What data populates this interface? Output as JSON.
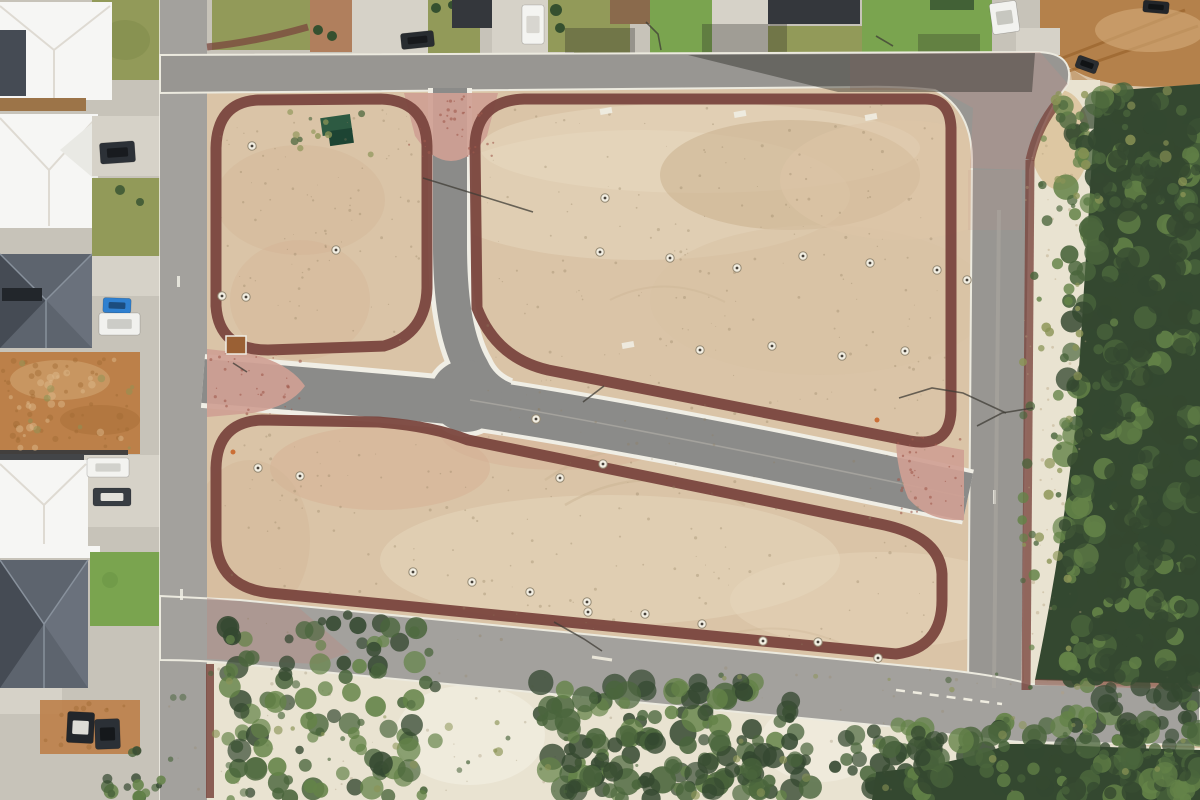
{
  "meta": {
    "description": "Aerial drone photograph of a cleared residential land subdivision: three bare sand lot blocks bounded by new asphalt roads and dark-red concrete footpaths, pink brick intersection aprons, existing houses along the western and northern streets, a dirt track at the north-east corner, and coastal bushland with white sand dunes to the east and south.",
    "image_width": 1200,
    "image_height": 800
  },
  "features": {
    "development": "Cleared subdivision sand lots",
    "roads": "New asphalt subdivision roads",
    "footpaths": "Dark red concrete footpaths with rounded corners",
    "aprons": "Pink brick-paved intersection aprons",
    "left_neighborhood": "Existing houses along western street",
    "top_neighborhood": "Existing houses along northern street",
    "bushland": "Coastal bushland and white sand dunes",
    "dirt_track": "Unsealed sand track at north-east corner",
    "dumpster": "Green waste skip bins on lot",
    "utility_markers": "Sewer/service lids on lots"
  },
  "palette": {
    "sand": "#dac4a7",
    "sand_light": "#e6d7bd",
    "sand_pink": "#d5b093",
    "sand_mottle": "#c8ad8a",
    "road": "#989692",
    "road_light": "#a3a19d",
    "road_internal": "#8b8b89",
    "curb": "#f0eee5",
    "maroon": "#7a463e",
    "maroon_dark": "#6b3d36",
    "pink": "#cf9f94",
    "pink_tint": "#c09287",
    "lawn": "#929a59",
    "lawn_bright": "#7aa44f",
    "hedge": "#35502f",
    "olive": "#8b9456",
    "bush_dark": "#344830",
    "bush_mid": "#4a653c",
    "bush_light": "#648348",
    "dune": "#e9e3d1",
    "dune_bright": "#f0ebdd",
    "dirt": "#b4814b",
    "dirt_dark": "#9c672f",
    "dirt_light": "#d3ab79",
    "dirt_lot": "#bc8049",
    "roof_white": "#f6f6f4",
    "roof_white_shade": "#e9e9e4",
    "roof_gray": "#5d646e",
    "roof_gray_dark": "#454b54",
    "roof_gray_light": "#6a717c",
    "roof_dark": "#34373c",
    "roof_brown": "#8a6a4c",
    "tan_strip": "#9c7448",
    "concrete": "#c7c3b9",
    "concrete_light": "#d6d2c8",
    "shadow": "rgba(38,38,34,0.42)"
  },
  "seed": 1337,
  "vehicles": [
    {
      "name": "car-dark-driveway-nw",
      "x": 100,
      "y": 142,
      "w": 35,
      "h": 21,
      "rot": -4,
      "body": "#2c3137",
      "window": "#171a1e"
    },
    {
      "name": "car-blue",
      "x": 103,
      "y": 298,
      "w": 28,
      "h": 15,
      "rot": 2,
      "body": "#2f80d0",
      "window": "#1b4a7a"
    },
    {
      "name": "caravan-white",
      "x": 99,
      "y": 313,
      "w": 41,
      "h": 22,
      "rot": 0,
      "body": "#f1f1ee",
      "window": "#c9c9c4"
    },
    {
      "name": "van-white-west",
      "x": 87,
      "y": 458,
      "w": 42,
      "h": 19,
      "rot": 0,
      "body": "#f3f3f0",
      "window": "#cfcfc9"
    },
    {
      "name": "car-dark-west",
      "x": 93,
      "y": 488,
      "w": 38,
      "h": 18,
      "rot": 0,
      "body": "#383d43",
      "window": "#eceae4"
    },
    {
      "name": "ute-dark-lot-a",
      "x": 67,
      "y": 712,
      "w": 27,
      "h": 31,
      "rot": 3,
      "body": "#22262b",
      "window": "#e8e6df"
    },
    {
      "name": "ute-dark-lot-b",
      "x": 95,
      "y": 719,
      "w": 25,
      "h": 30,
      "rot": -2,
      "body": "#2b3036",
      "window": "#14171a"
    },
    {
      "name": "car-dark-top-lawn",
      "x": 401,
      "y": 32,
      "w": 33,
      "h": 16,
      "rot": -6,
      "body": "#282c30",
      "window": "#16181b"
    },
    {
      "name": "van-white-top",
      "x": 522,
      "y": 5,
      "w": 22,
      "h": 39,
      "rot": 0,
      "body": "#f4f4f1",
      "window": "#d6d4cd"
    },
    {
      "name": "car-white-top-right",
      "x": 991,
      "y": 2,
      "w": 27,
      "h": 31,
      "rot": -8,
      "body": "#f2f2ef",
      "window": "#c4c4bd"
    },
    {
      "name": "trailer-dark-dirt-track",
      "x": 1076,
      "y": 58,
      "w": 22,
      "h": 13,
      "rot": 20,
      "body": "#2a2d31",
      "window": "#101214"
    },
    {
      "name": "car-dark-top-edge",
      "x": 1143,
      "y": 1,
      "w": 26,
      "h": 12,
      "rot": 5,
      "body": "#23262a",
      "window": "#111315"
    }
  ],
  "utility_markers": [
    [
      222,
      296
    ],
    [
      246,
      297
    ],
    [
      336,
      250
    ],
    [
      252,
      146
    ],
    [
      600,
      252
    ],
    [
      670,
      258
    ],
    [
      737,
      268
    ],
    [
      803,
      256
    ],
    [
      870,
      263
    ],
    [
      937,
      270
    ],
    [
      967,
      280
    ],
    [
      605,
      198
    ],
    [
      536,
      419
    ],
    [
      603,
      464
    ],
    [
      700,
      350
    ],
    [
      772,
      346
    ],
    [
      842,
      356
    ],
    [
      905,
      351
    ],
    [
      258,
      468
    ],
    [
      300,
      476
    ],
    [
      560,
      478
    ],
    [
      413,
      572
    ],
    [
      472,
      582
    ],
    [
      530,
      592
    ],
    [
      587,
      602
    ],
    [
      588,
      612
    ],
    [
      645,
      614
    ],
    [
      702,
      624
    ],
    [
      763,
      641
    ],
    [
      818,
      642
    ],
    [
      878,
      658
    ]
  ],
  "survey_pegs": [
    [
      606,
      111
    ],
    [
      740,
      114
    ],
    [
      871,
      117
    ],
    [
      628,
      345
    ]
  ],
  "light_poles": [
    [
      [
        646,
        22
      ],
      [
        658,
        34
      ],
      [
        661,
        50
      ]
    ],
    [
      [
        876,
        36
      ],
      [
        893,
        46
      ]
    ],
    [
      [
        583,
        402
      ],
      [
        604,
        386
      ]
    ],
    [
      [
        899,
        398
      ],
      [
        932,
        388
      ],
      [
        963,
        393
      ],
      [
        1006,
        413
      ]
    ],
    [
      [
        977,
        426
      ],
      [
        1002,
        413
      ],
      [
        1033,
        408
      ]
    ],
    [
      [
        554,
        622
      ],
      [
        584,
        639
      ],
      [
        602,
        651
      ]
    ],
    [
      [
        233,
        363
      ],
      [
        247,
        372
      ]
    ],
    [
      [
        423,
        178
      ],
      [
        533,
        212
      ]
    ]
  ],
  "vegetation_regions": [
    {
      "name": "right-bushland",
      "bounds": [
        1062,
        88,
        138,
        712
      ],
      "count": 300,
      "rmin": 4,
      "rmax": 13,
      "colors": [
        "bush_dark",
        "bush_mid",
        "bush_light"
      ],
      "opacity": 0.92
    },
    {
      "name": "right-bushland-shade",
      "bounds": [
        1100,
        100,
        100,
        700
      ],
      "count": 120,
      "rmin": 5,
      "rmax": 15,
      "colors": [
        "bush_dark"
      ],
      "opacity": 0.85
    },
    {
      "name": "dune-shrubs",
      "bounds": [
        1022,
        110,
        58,
        580
      ],
      "count": 55,
      "rmin": 2,
      "rmax": 6,
      "colors": [
        "bush_mid",
        "olive",
        "bush_light"
      ],
      "opacity": 0.85
    },
    {
      "name": "topright-dune-shrubs",
      "bounds": [
        1040,
        85,
        150,
        140
      ],
      "count": 30,
      "rmin": 2,
      "rmax": 6,
      "colors": [
        "bush_mid",
        "olive"
      ],
      "opacity": 0.85
    },
    {
      "name": "bottomleft-clump",
      "bounds": [
        222,
        615,
        215,
        185
      ],
      "count": 110,
      "rmin": 4,
      "rmax": 12,
      "colors": [
        "bush_dark",
        "bush_mid",
        "bush_light"
      ],
      "opacity": 0.9
    },
    {
      "name": "bottom-center-trees",
      "bounds": [
        540,
        682,
        260,
        118
      ],
      "count": 110,
      "rmin": 5,
      "rmax": 14,
      "colors": [
        "bush_dark",
        "bush_mid",
        "bush_light"
      ],
      "opacity": 0.9
    },
    {
      "name": "bottom-dense-strip",
      "bounds": [
        555,
        735,
        450,
        65
      ],
      "count": 90,
      "rmin": 5,
      "rmax": 12,
      "colors": [
        "bush_dark",
        "bush_mid"
      ],
      "opacity": 0.9
    },
    {
      "name": "bottom-right-merge",
      "bounds": [
        870,
        722,
        330,
        78
      ],
      "count": 110,
      "rmin": 5,
      "rmax": 13,
      "colors": [
        "bush_dark",
        "bush_mid",
        "bush_light"
      ],
      "opacity": 0.92
    },
    {
      "name": "bottom-sparse-shrubs",
      "bounds": [
        170,
        672,
        1020,
        126
      ],
      "count": 70,
      "rmin": 1.5,
      "rmax": 4.5,
      "colors": [
        "bush_mid",
        "olive"
      ],
      "opacity": 0.7
    },
    {
      "name": "block1-weeds",
      "bounds": [
        288,
        108,
        85,
        48
      ],
      "count": 12,
      "rmin": 1.5,
      "rmax": 4,
      "colors": [
        "olive",
        "bush_mid"
      ],
      "opacity": 0.8
    },
    {
      "name": "left-strip-bush",
      "bounds": [
        104,
        750,
        62,
        48
      ],
      "count": 16,
      "rmin": 3,
      "rmax": 8,
      "colors": [
        "bush_dark",
        "bush_mid",
        "bush_light"
      ],
      "opacity": 0.9
    },
    {
      "name": "west-dirt-weeds",
      "bounds": [
        5,
        360,
        130,
        90
      ],
      "count": 10,
      "rmin": 1.5,
      "rmax": 4,
      "colors": [
        "olive"
      ],
      "opacity": 0.6
    }
  ],
  "speck_regions": [
    {
      "bounds": [
        218,
        102,
        205,
        240
      ],
      "count": 90,
      "rmin": 0.4,
      "rmax": 1.5,
      "color": "#8f7c5e",
      "opacity": 0.32
    },
    {
      "bounds": [
        480,
        102,
        465,
        320
      ],
      "count": 190,
      "rmin": 0.4,
      "rmax": 1.6,
      "color": "#8f7c5e",
      "opacity": 0.32
    },
    {
      "bounds": [
        222,
        432,
        715,
        215
      ],
      "count": 170,
      "rmin": 0.4,
      "rmax": 1.6,
      "color": "#8f7c5e",
      "opacity": 0.32
    },
    {
      "bounds": [
        168,
        668,
        1020,
        125
      ],
      "count": 110,
      "rmin": 0.5,
      "rmax": 1.8,
      "color": "#97876a",
      "opacity": 0.3
    },
    {
      "bounds": [
        1024,
        95,
        62,
        620
      ],
      "count": 60,
      "rmin": 0.5,
      "rmax": 1.8,
      "color": "#b3a17c",
      "opacity": 0.4
    },
    {
      "bounds": [
        3,
        358,
        138,
        92
      ],
      "count": 45,
      "rmin": 1,
      "rmax": 3.5,
      "color": "#a06a34",
      "opacity": 0.45
    },
    {
      "bounds": [
        3,
        358,
        138,
        92
      ],
      "count": 28,
      "rmin": 1.5,
      "rmax": 4,
      "color": "#dcb88a",
      "opacity": 0.5
    },
    {
      "bounds": [
        44,
        702,
        92,
        48
      ],
      "count": 22,
      "rmin": 1,
      "rmax": 3,
      "color": "#a06a34",
      "opacity": 0.45
    },
    {
      "bounds": [
        408,
        96,
        86,
        62
      ],
      "count": 34,
      "rmin": 0.6,
      "rmax": 1.7,
      "color": "#a05a4c",
      "opacity": 0.6
    },
    {
      "bounds": [
        210,
        352,
        92,
        62
      ],
      "count": 34,
      "rmin": 0.6,
      "rmax": 1.7,
      "color": "#a05a4c",
      "opacity": 0.6
    },
    {
      "bounds": [
        898,
        436,
        64,
        78
      ],
      "count": 34,
      "rmin": 0.6,
      "rmax": 1.7,
      "color": "#a05a4c",
      "opacity": 0.6
    }
  ]
}
